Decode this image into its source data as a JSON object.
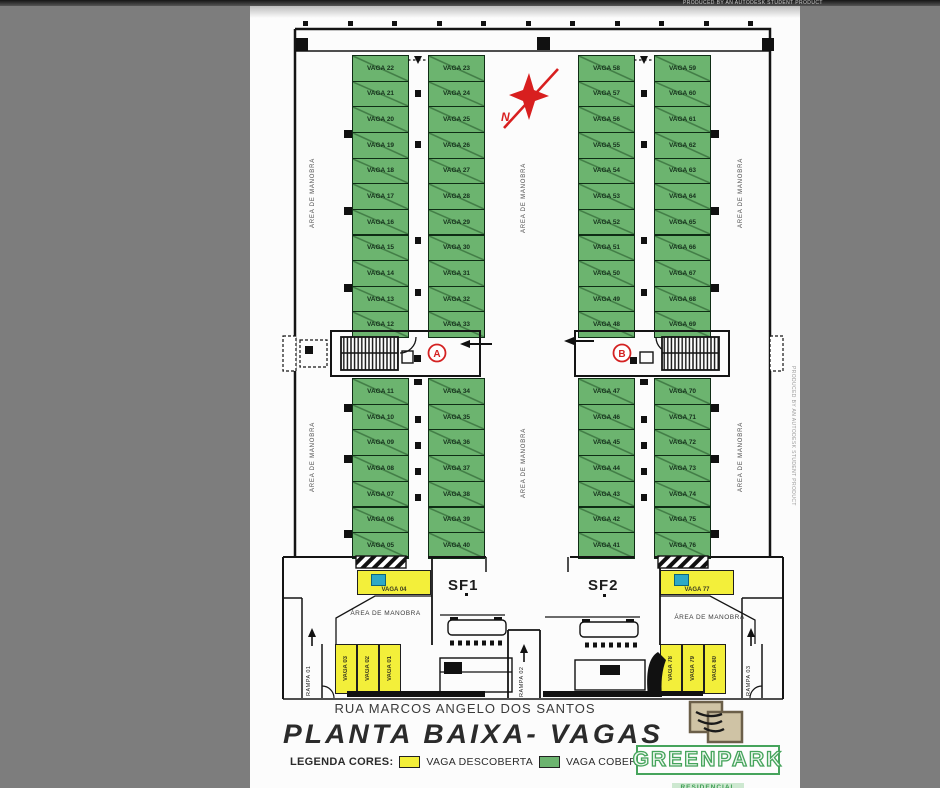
{
  "document": {
    "watermark": "PRODUCED BY AN AUTODESK STUDENT PRODUCT",
    "street_label": "RUA MARCOS ANGELO DOS SANTOS",
    "title": "PLANTA BAIXA- VAGAS",
    "legend_label": "LEGENDA CORES:",
    "legend_items": [
      {
        "label": "VAGA DESCOBERTA",
        "color": "#f3ef3a"
      },
      {
        "label": "VAGA COBERTA",
        "color": "#6cb46f"
      }
    ]
  },
  "brand": {
    "name": "GREENPARK",
    "subtitle": "RESIDENCIAL"
  },
  "compass": {
    "label": "N."
  },
  "labels": {
    "manobra": "ÁREA DE MANOBRA",
    "sf1": "SF1",
    "sf2": "SF2",
    "ramp1": "RAMPA 01",
    "ramp2": "RAMPA 02",
    "ramp3": "RAMPA 03",
    "core_a": "A",
    "core_b": "B"
  },
  "colors": {
    "covered": "#6cb46f",
    "uncovered": "#f3ef3a",
    "accessible": "#2ea9c6",
    "wall": "#141414",
    "red": "#d81f1f",
    "background": "#7d7d7d"
  },
  "parking": {
    "covered_columns": [
      {
        "name": "upper-left-a",
        "x": 352,
        "y": 55,
        "w": 57,
        "cell_h": 25.64,
        "labels": [
          "VAGA 22",
          "VAGA 21",
          "VAGA 20",
          "VAGA 19",
          "VAGA 18",
          "VAGA 17",
          "VAGA 16",
          "VAGA 15",
          "VAGA 14",
          "VAGA 13",
          "VAGA 12"
        ]
      },
      {
        "name": "upper-left-b",
        "x": 428,
        "y": 55,
        "w": 57,
        "cell_h": 25.64,
        "labels": [
          "VAGA 23",
          "VAGA 24",
          "VAGA 25",
          "VAGA 26",
          "VAGA 27",
          "VAGA 28",
          "VAGA 29",
          "VAGA 30",
          "VAGA 31",
          "VAGA 32",
          "VAGA 33"
        ]
      },
      {
        "name": "upper-right-a",
        "x": 578,
        "y": 55,
        "w": 57,
        "cell_h": 25.64,
        "labels": [
          "VAGA 58",
          "VAGA 57",
          "VAGA 56",
          "VAGA 55",
          "VAGA 54",
          "VAGA 53",
          "VAGA 52",
          "VAGA 51",
          "VAGA 50",
          "VAGA 49",
          "VAGA 48"
        ]
      },
      {
        "name": "upper-right-b",
        "x": 654,
        "y": 55,
        "w": 57,
        "cell_h": 25.64,
        "labels": [
          "VAGA 59",
          "VAGA 60",
          "VAGA 61",
          "VAGA 62",
          "VAGA 63",
          "VAGA 64",
          "VAGA 65",
          "VAGA 66",
          "VAGA 67",
          "VAGA 68",
          "VAGA 69"
        ]
      },
      {
        "name": "lower-left-a",
        "x": 352,
        "y": 378,
        "w": 57,
        "cell_h": 25.7,
        "labels": [
          "VAGA 11",
          "VAGA 10",
          "VAGA 09",
          "VAGA 08",
          "VAGA 07",
          "VAGA 06",
          "VAGA 05"
        ]
      },
      {
        "name": "lower-left-b",
        "x": 428,
        "y": 378,
        "w": 57,
        "cell_h": 25.7,
        "labels": [
          "VAGA 34",
          "VAGA 35",
          "VAGA 36",
          "VAGA 37",
          "VAGA 38",
          "VAGA 39",
          "VAGA 40"
        ]
      },
      {
        "name": "lower-right-a",
        "x": 578,
        "y": 378,
        "w": 57,
        "cell_h": 25.7,
        "labels": [
          "VAGA 47",
          "VAGA 46",
          "VAGA 45",
          "VAGA 44",
          "VAGA 43",
          "VAGA 42",
          "VAGA 41"
        ]
      },
      {
        "name": "lower-right-b",
        "x": 654,
        "y": 378,
        "w": 57,
        "cell_h": 25.7,
        "labels": [
          "VAGA 70",
          "VAGA 71",
          "VAGA 72",
          "VAGA 73",
          "VAGA 74",
          "VAGA 75",
          "VAGA 76"
        ]
      }
    ],
    "uncovered_spaces": [
      {
        "label": "VAGA 04",
        "x": 357,
        "y": 570,
        "w": 74,
        "h": 25,
        "vertical": false,
        "accessible": true
      },
      {
        "label": "VAGA 03",
        "x": 335,
        "y": 644,
        "w": 22,
        "h": 50,
        "vertical": true,
        "accessible": false
      },
      {
        "label": "VAGA 02",
        "x": 357,
        "y": 644,
        "w": 22,
        "h": 50,
        "vertical": true,
        "accessible": false
      },
      {
        "label": "VAGA 01",
        "x": 379,
        "y": 644,
        "w": 22,
        "h": 50,
        "vertical": true,
        "accessible": false
      },
      {
        "label": "VAGA 77",
        "x": 660,
        "y": 570,
        "w": 74,
        "h": 25,
        "vertical": false,
        "accessible": true
      },
      {
        "label": "VAGA 78",
        "x": 660,
        "y": 644,
        "w": 22,
        "h": 50,
        "vertical": true,
        "accessible": false
      },
      {
        "label": "VAGA 79",
        "x": 682,
        "y": 644,
        "w": 22,
        "h": 50,
        "vertical": true,
        "accessible": false
      },
      {
        "label": "VAGA 80",
        "x": 704,
        "y": 644,
        "w": 22,
        "h": 50,
        "vertical": true,
        "accessible": false
      }
    ]
  }
}
